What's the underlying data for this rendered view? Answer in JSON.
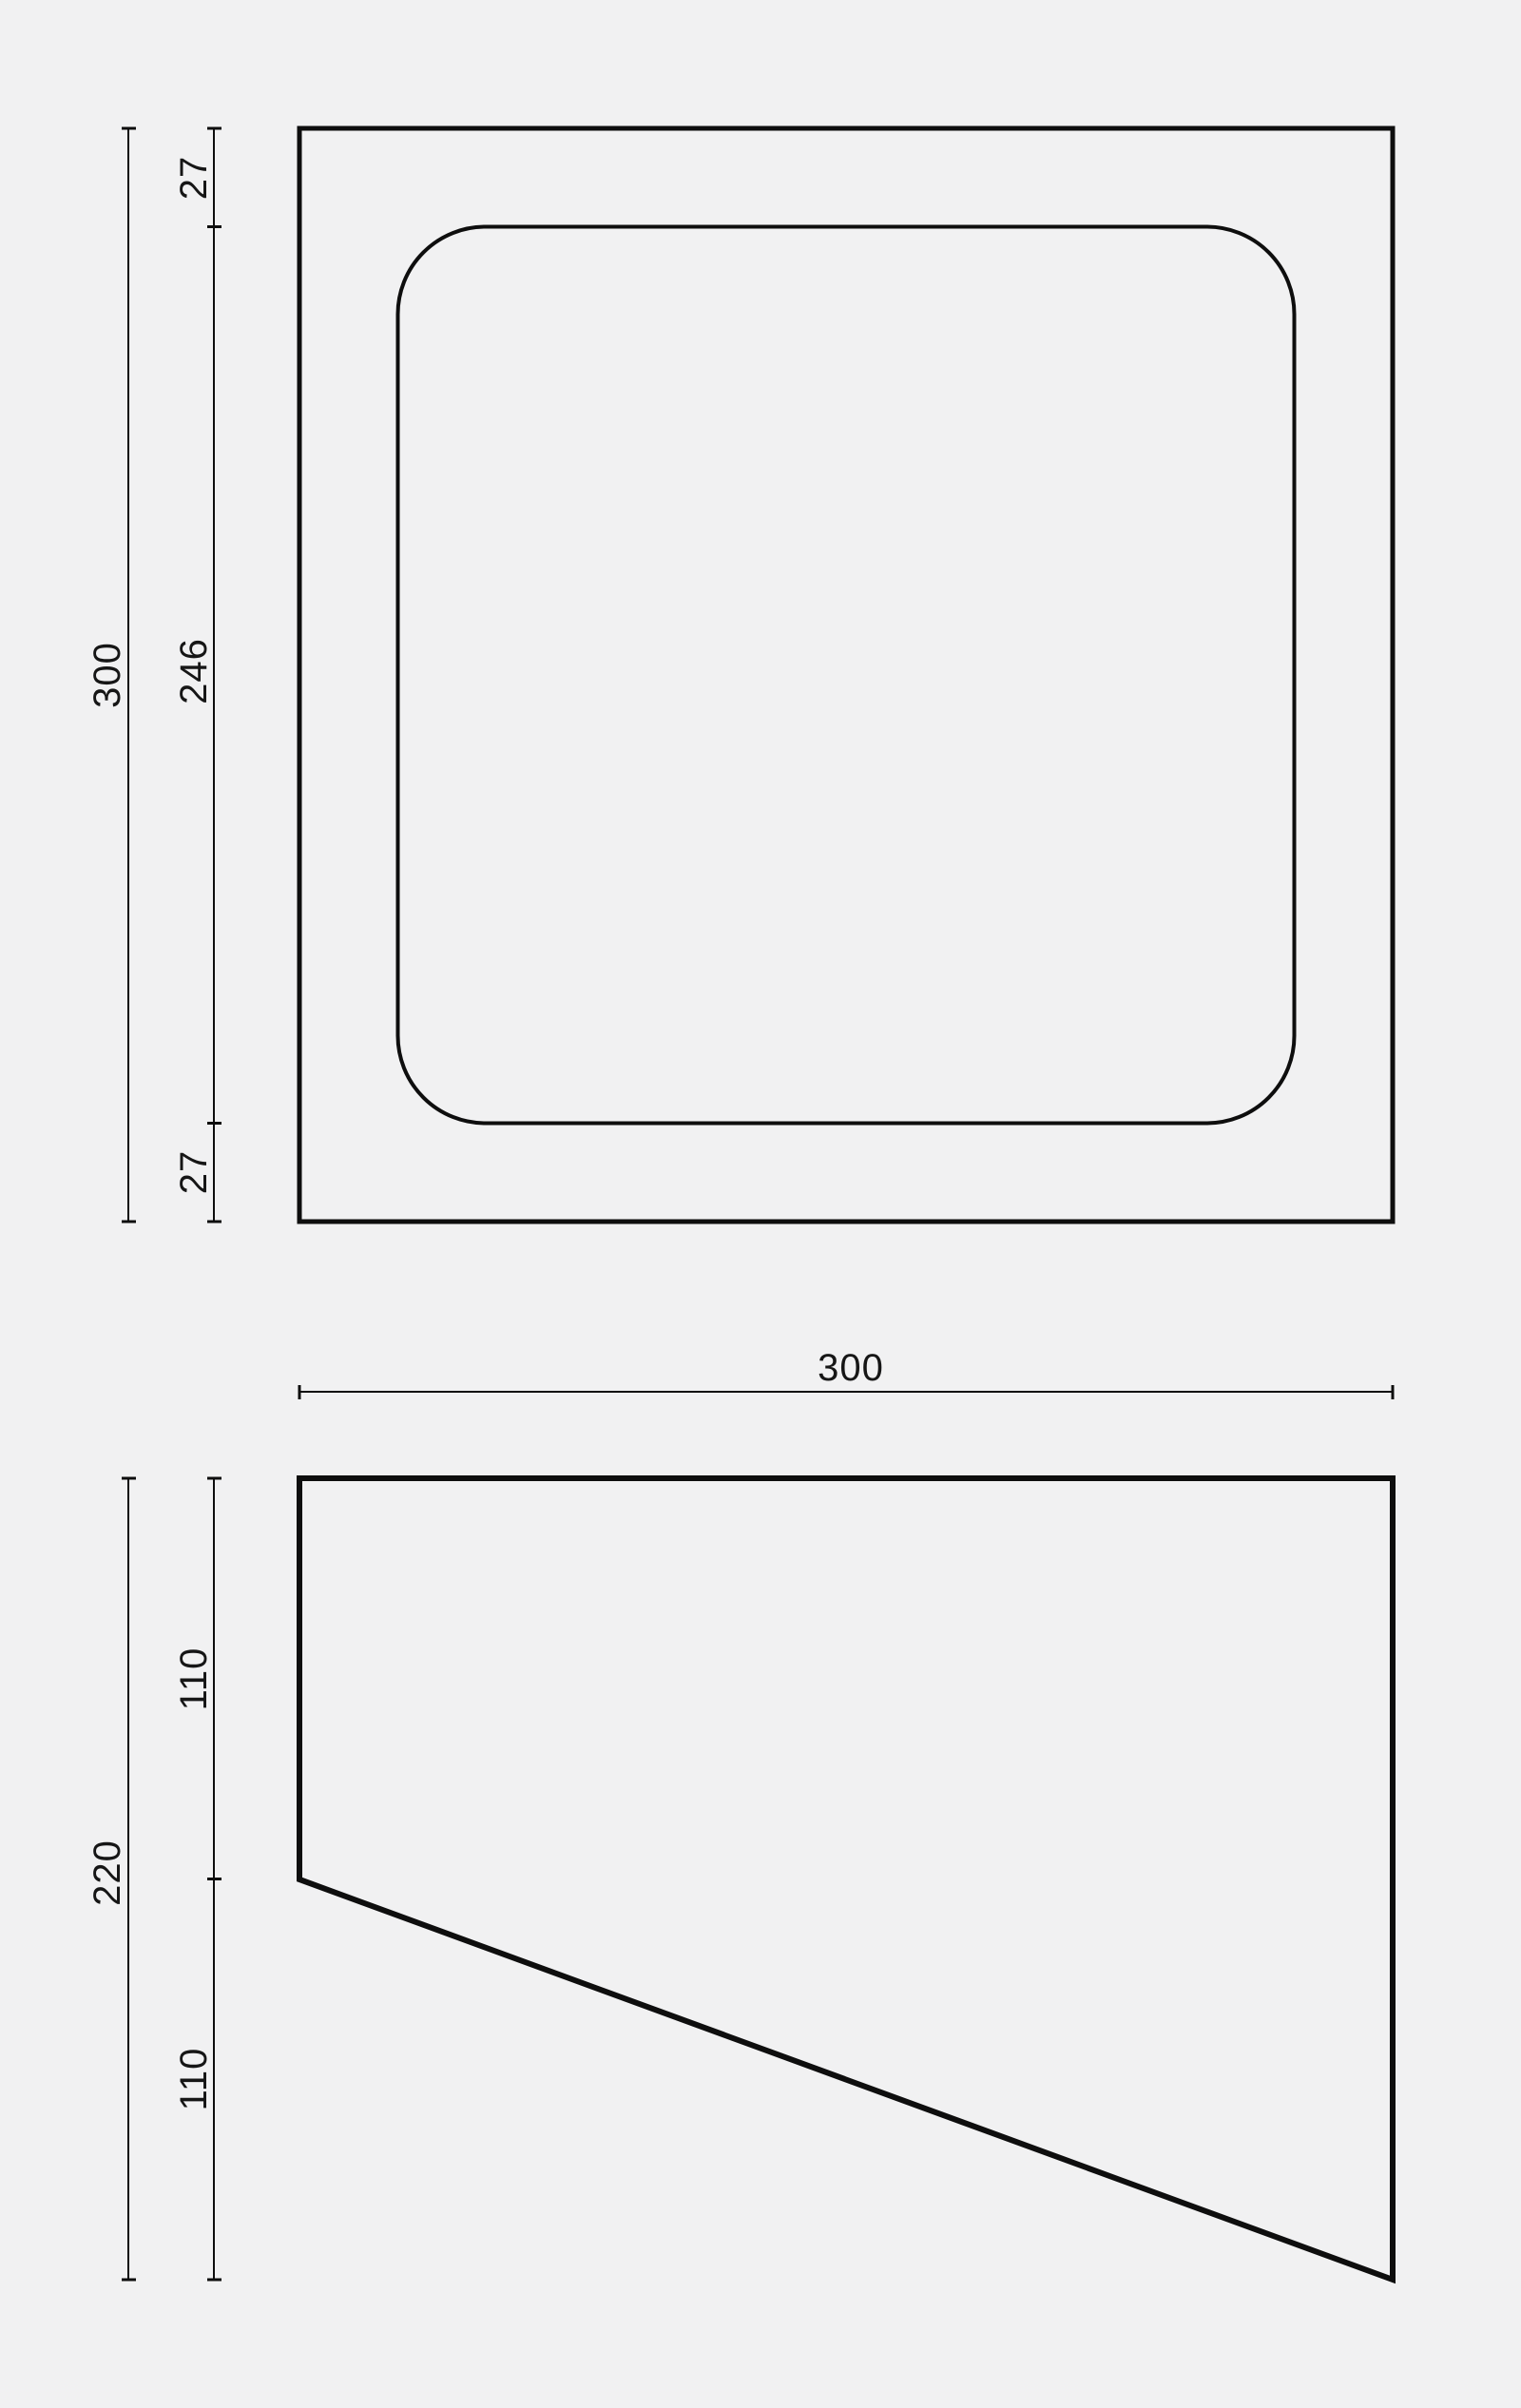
{
  "colors": {
    "background": "#f1f1f2",
    "line": "#0e0e0e",
    "text": "#161616"
  },
  "plan_view": {
    "dim_height_total": "300",
    "dim_margin_top": "27",
    "dim_opening": "246",
    "dim_margin_bottom": "27"
  },
  "profile_view": {
    "dim_width_total": "300",
    "dim_height_total": "220",
    "dim_height_upper": "110",
    "dim_height_lower": "110"
  }
}
